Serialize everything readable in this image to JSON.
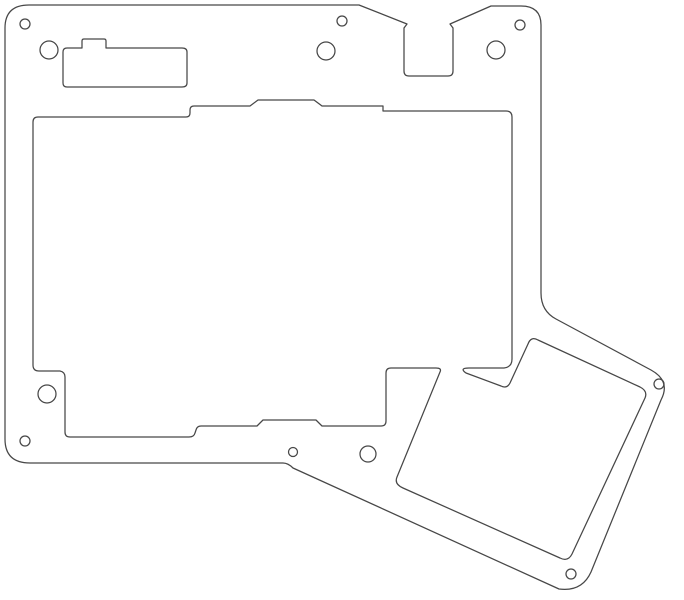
{
  "drawing": {
    "title": "flat-panel-outline-drawing",
    "canvas": {
      "width": 684,
      "height": 600,
      "background_color": "#ffffff",
      "line_color": "#474747",
      "line_width": 1.25
    },
    "shapes": [
      {
        "name": "outer-plate-outline",
        "role": "outer boundary of plate with top slot notch and angled bottom-right extension",
        "d": "M 5 28 Q 5 5 29 5 L 359 5 L 407 24 L 404 28 L 404 71 Q 404 76 409 76 L 448 76 Q 453 76 453 71 L 453 28 L 450 24 L 491 6 L 521 6 Q 541 6 541 25 L 541 293 Q 541 311 556 319 L 651 370 Q 671 381 661 400 L 591 572 Q 582 592 559 589 L 293 468 Q 288 463 283 463 L 30 463 Q 5 463 5 439 Z"
      },
      {
        "name": "main-compound-cutout",
        "role": "large stepped rectangular window joined to rotated square window with wedge tab at junction",
        "d": "M 33 122 Q 33 117 38 117 L 186 117 Q 190 117 190 113 L 190 110 Q 190 106 194 106 L 250 106 L 258 100 L 314 100 L 322 106 L 383 106 L 383 111 L 506 111 Q 512 111 512 117 L 512 359 Q 512 367 504 368 L 469 368 Q 459 368 466 373 L 501 386 Q 507 389 510 383 L 528 344 Q 531 336 538 340 L 640 387 Q 648 391 645 398 L 572 554 Q 568 562 560 558 L 403 488 Q 394 484 397 477 L 440 372 Q 442 368 436 368 L 391 368 Q 386 368 386 373 L 386 421 Q 386 426 381 426 L 322 426 L 316 420 L 263 420 L 257 426 L 201 426 Q 197 426 196 430 L 195 433 Q 194 437 189 437 L 70 437 Q 65 437 65 432 L 65 377 Q 65 372 60 371 L 39 371 Q 33 371 33 365 Z"
      },
      {
        "name": "connector-slot-cutout",
        "role": "small rectangular slot with raised key notch, upper left",
        "d": "M 63 52 Q 63 48 67 48 L 82 48 L 82 41 Q 82 39 84 39 L 104 39 Q 106 39 106 41 L 106 48 L 182 48 Q 187 48 187 52 L 187 83 Q 187 87 182 87 L 67 87 Q 63 87 63 83 Z"
      }
    ],
    "holes": [
      {
        "name": "mounting-hole-top-left-small",
        "cx": 25,
        "cy": 24,
        "r": 5
      },
      {
        "name": "mounting-hole-top-left-large",
        "cx": 49,
        "cy": 50,
        "r": 9
      },
      {
        "name": "mounting-hole-top-mid-small",
        "cx": 342,
        "cy": 21,
        "r": 5
      },
      {
        "name": "mounting-hole-top-mid-large",
        "cx": 326,
        "cy": 51,
        "r": 9
      },
      {
        "name": "mounting-hole-top-right-small",
        "cx": 520,
        "cy": 25,
        "r": 5
      },
      {
        "name": "mounting-hole-top-right-large",
        "cx": 496,
        "cy": 50,
        "r": 9
      },
      {
        "name": "mounting-hole-bottom-left-large",
        "cx": 47,
        "cy": 394,
        "r": 9
      },
      {
        "name": "mounting-hole-bottom-left-small",
        "cx": 25,
        "cy": 441,
        "r": 5
      },
      {
        "name": "mounting-hole-bottom-mid-small",
        "cx": 293,
        "cy": 452,
        "r": 4.5
      },
      {
        "name": "mounting-hole-bottom-mid-large",
        "cx": 368,
        "cy": 454,
        "r": 8
      },
      {
        "name": "mounting-hole-extension-right",
        "cx": 659,
        "cy": 384,
        "r": 5
      },
      {
        "name": "mounting-hole-extension-bottom",
        "cx": 571,
        "cy": 574,
        "r": 5
      }
    ]
  }
}
